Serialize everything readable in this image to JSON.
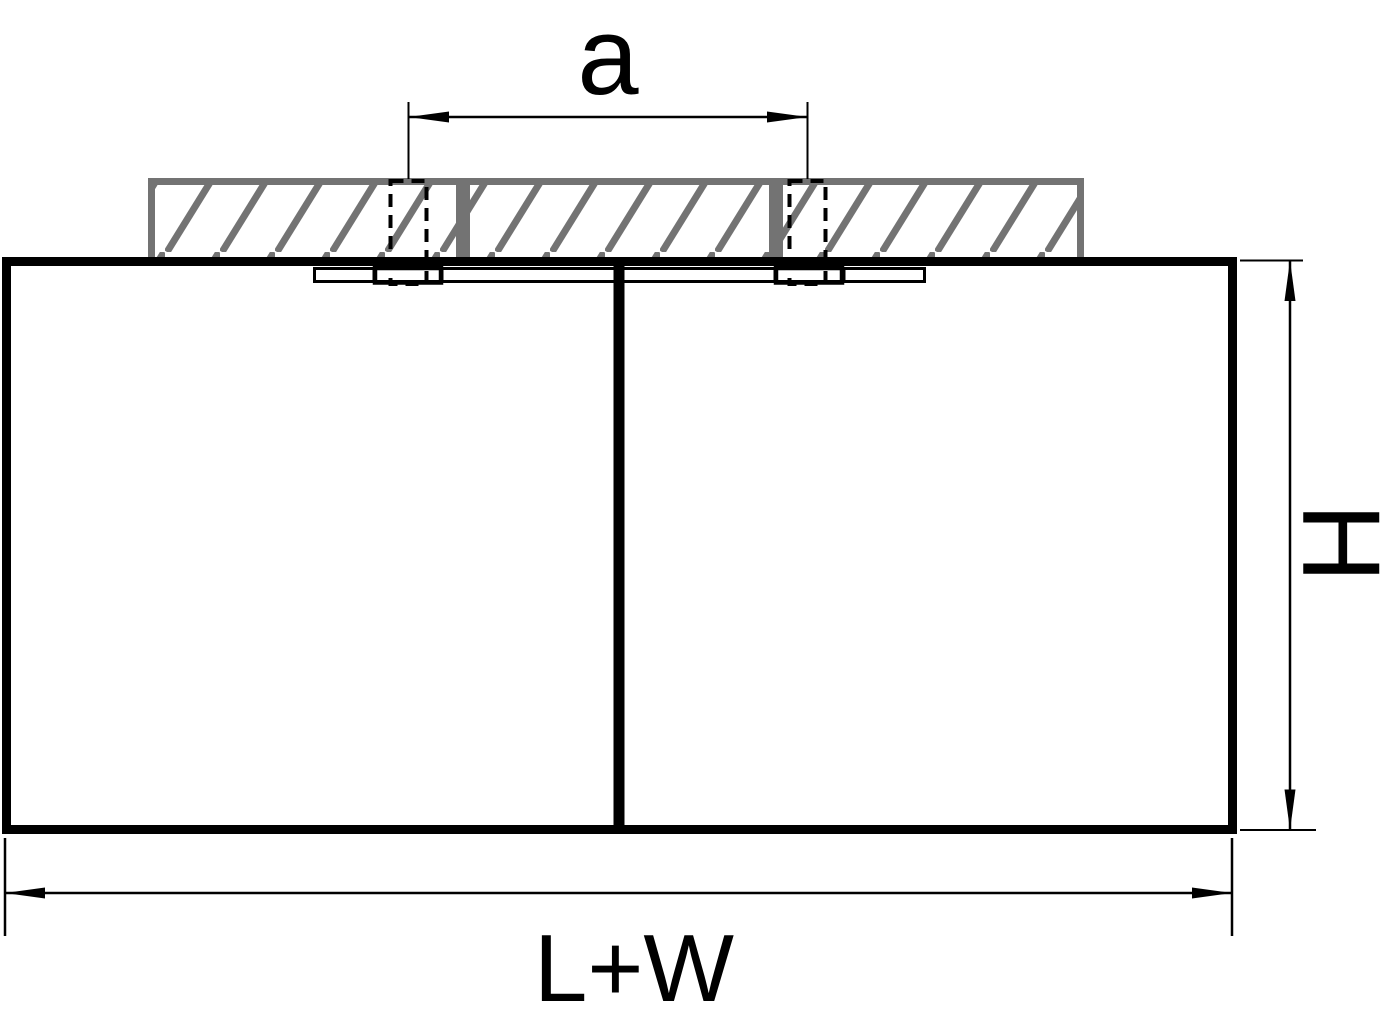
{
  "drawing": {
    "labels": {
      "mounting_spacing": "a",
      "height": "H",
      "total_length": "L+W"
    },
    "colors": {
      "line": "#000000",
      "hatch_gray": "#737373",
      "background": "#ffffff"
    }
  }
}
